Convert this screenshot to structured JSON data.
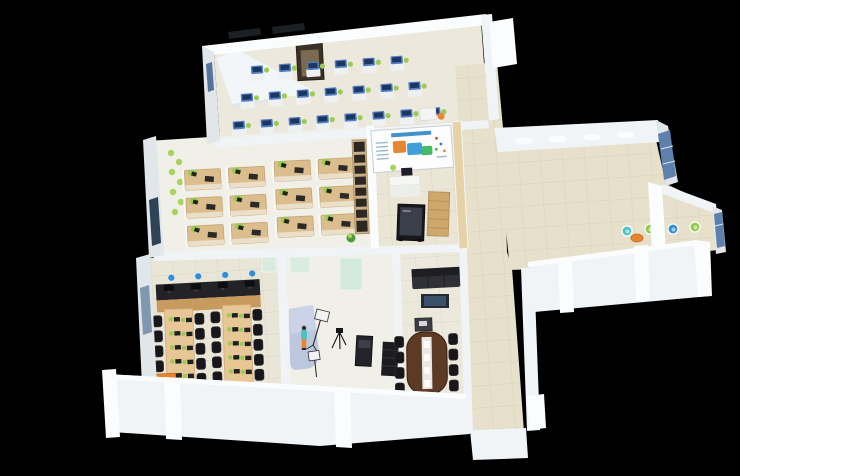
{
  "meta": {
    "type": "3d-isometric-office-floorplan-render",
    "canvas": {
      "width": 846,
      "height": 476
    }
  },
  "colors": {
    "background": "#000000",
    "rightMargin": "#ffffff",
    "wall": "#f1f4f6",
    "wallBright": "#fafcfd",
    "wallShade": "#e0e6e9",
    "wallDark": "#cfd7db",
    "floor": "#ece9dc",
    "floorWarm": "#e7e1cc",
    "floorLight": "#f0efe8",
    "tileLine": "#00000014",
    "wood": "#dcbd8e",
    "woodDark": "#c79a5e",
    "woodPanel": "#e7d2a8",
    "deskBlue": "#4f7fc4",
    "monitorNavy": "#1d3563",
    "chairGreen": "#9ccb55",
    "plantGreen": "#a6d45e",
    "chairBlack": "#17171b",
    "tableWood": "#5d3a24",
    "sofaBlack": "#1d1d22",
    "screenDark": "#3b3f4a",
    "kioskBlack": "#17181c",
    "backdropBlue": "#bdc8de",
    "accentOrange": "#e6862e",
    "accentTeal": "#4cc4c4",
    "accentBlue": "#2f8fd0",
    "accentGreen": "#8fca4a",
    "bannerBlue": "#2f86c8",
    "windowBlue": "#5d80ac",
    "windowDark": "#2e4258",
    "glassGreen": "#d6ecdf",
    "cabinetBrown": "#3c3128",
    "cabinetInner": "#7a6a4f"
  },
  "scene": {
    "description": "Isometric 3D cutaway render of an office floor on a black background with a white strip on the right edge",
    "rooms": [
      {
        "id": "computer-training-room",
        "position": "top-left",
        "furniture": {
          "blue-desk-rows": [
            6,
            7,
            8
          ],
          "storage-cabinet": 1,
          "teacher-desk": 1,
          "angled-screen-wall": 1
        }
      },
      {
        "id": "open-plan-office",
        "position": "middle-left",
        "furniture": {
          "workstation-clusters": 2,
          "desks-per-cluster": 6,
          "ladder-bookshelf": 1,
          "wall-planter": 1,
          "floor-plant": 1
        }
      },
      {
        "id": "exhibition-reception",
        "position": "center",
        "furniture": {
          "info-banner": 1,
          "reception-desk": 1,
          "kiosk-display": 1,
          "wood-cabinet": 1,
          "wood-wall-panel": 1
        }
      },
      {
        "id": "training-classroom",
        "position": "bottom-left",
        "furniture": {
          "monitor-counter": 1,
          "bar-stools": 4,
          "long-tables": 2,
          "black-chairs": 23,
          "orange-desk": 1
        }
      },
      {
        "id": "photo-studio",
        "position": "bottom-center",
        "furniture": {
          "blue-backdrop": 1,
          "model-figure": 1,
          "softbox-lights": 2,
          "camera-tripod": 1,
          "equipment-desk": 1,
          "equipment-rack": 1,
          "glass-partitions": 3
        }
      },
      {
        "id": "conference-room",
        "position": "bottom-center-right",
        "furniture": {
          "oval-table": 1,
          "chairs": 9,
          "sofa": 1,
          "tv-cabinet": 1,
          "lectern": 1
        }
      },
      {
        "id": "corridor",
        "position": "center-vertical"
      },
      {
        "id": "lounge-hall",
        "position": "right-wing",
        "furniture": {
          "lounge-chairs": 4,
          "round-table": 1,
          "window-panels": 2,
          "ceiling-lights": 4
        }
      }
    ]
  },
  "layout": {
    "grids": [
      {
        "use": "sym-blue-desk",
        "into": "g-top-desks",
        "x": 252,
        "y": 60,
        "cols": 6,
        "dx": 28
      },
      {
        "use": "sym-blue-desk",
        "into": "g-top-desks",
        "x": 240,
        "y": 87,
        "cols": 7,
        "dx": 28
      },
      {
        "use": "sym-blue-desk",
        "into": "g-top-desks",
        "x": 230,
        "y": 114,
        "cols": 8,
        "dx": 28
      },
      {
        "use": "sym-ws-desk",
        "into": "g-office-desks",
        "x": 186,
        "y": 166,
        "cols": 2,
        "rows": 3,
        "dx": 44,
        "dy": 28
      },
      {
        "use": "sym-ws-desk",
        "into": "g-office-desks",
        "x": 276,
        "y": 162,
        "cols": 2,
        "rows": 3,
        "dx": 44,
        "dy": 28
      },
      {
        "use": "sym-counter-monitor",
        "into": "g-counter-monitors",
        "x": 164,
        "y": 283,
        "cols": 4,
        "dx": 27
      },
      {
        "use": "sym-stool",
        "into": "g-stools",
        "x": 172,
        "y": 276,
        "cols": 4,
        "dx": 27
      },
      {
        "use": "sym-black-chair",
        "into": "g-class-chairs",
        "x": 154,
        "y": 314,
        "rows": 5,
        "dy": 15
      },
      {
        "use": "sym-black-chair",
        "into": "g-class-chairs",
        "x": 196,
        "y": 313,
        "rows": 5,
        "dy": 15
      },
      {
        "use": "sym-black-chair",
        "into": "g-class-chairs",
        "x": 212,
        "y": 312,
        "rows": 5,
        "dy": 15
      },
      {
        "use": "sym-black-chair",
        "into": "g-class-chairs",
        "x": 254,
        "y": 311,
        "rows": 5,
        "dy": 15
      },
      {
        "use": "sym-table-item",
        "into": "g-table-items",
        "x": 172,
        "y": 318,
        "rows": 5,
        "dy": 14
      },
      {
        "use": "sym-table-item",
        "into": "g-table-items",
        "x": 184,
        "y": 319,
        "rows": 5,
        "dy": 14
      },
      {
        "use": "sym-table-item",
        "into": "g-table-items",
        "x": 230,
        "y": 316,
        "rows": 5,
        "dy": 14
      },
      {
        "use": "sym-table-item",
        "into": "g-table-items",
        "x": 242,
        "y": 317,
        "rows": 5,
        "dy": 14
      },
      {
        "use": "sym-black-chair",
        "into": "g-conf-chairs",
        "x": 395,
        "y": 336,
        "rows": 4,
        "dy": 15.5
      },
      {
        "use": "sym-black-chair",
        "into": "g-conf-chairs",
        "x": 449,
        "y": 334,
        "rows": 4,
        "dy": 15.5
      }
    ],
    "singles": [
      {
        "use": "sym-ceiling-light",
        "into": "g-wing-lights",
        "x": 524,
        "y": 141
      },
      {
        "use": "sym-ceiling-light",
        "into": "g-wing-lights",
        "x": 558,
        "y": 139
      },
      {
        "use": "sym-ceiling-light",
        "into": "g-wing-lights",
        "x": 592,
        "y": 137
      },
      {
        "use": "sym-ceiling-light",
        "into": "g-wing-lights",
        "x": 626,
        "y": 135
      },
      {
        "use": "sym-black-chair",
        "into": "g-class-chairs",
        "x": 173,
        "y": 386
      },
      {
        "use": "sym-black-chair",
        "into": "g-class-chairs",
        "x": 231,
        "y": 385
      },
      {
        "use": "sym-black-chair",
        "into": "g-class-chairs",
        "x": 180,
        "y": 380
      },
      {
        "use": "sym-black-chair",
        "into": "g-conf-chairs",
        "x": 421,
        "y": 393
      },
      {
        "use": "sym-lounge-chair",
        "into": "g-lounge",
        "x": 627,
        "y": 231,
        "fill": "accentTeal"
      },
      {
        "use": "sym-lounge-chair",
        "into": "g-lounge",
        "x": 650,
        "y": 229,
        "fill": "accentGreen"
      },
      {
        "use": "sym-lounge-chair",
        "into": "g-lounge",
        "x": 673,
        "y": 229,
        "fill": "accentBlue"
      },
      {
        "use": "sym-lounge-chair",
        "into": "g-lounge",
        "x": 695,
        "y": 227,
        "fill": "accentGreen"
      }
    ]
  }
}
